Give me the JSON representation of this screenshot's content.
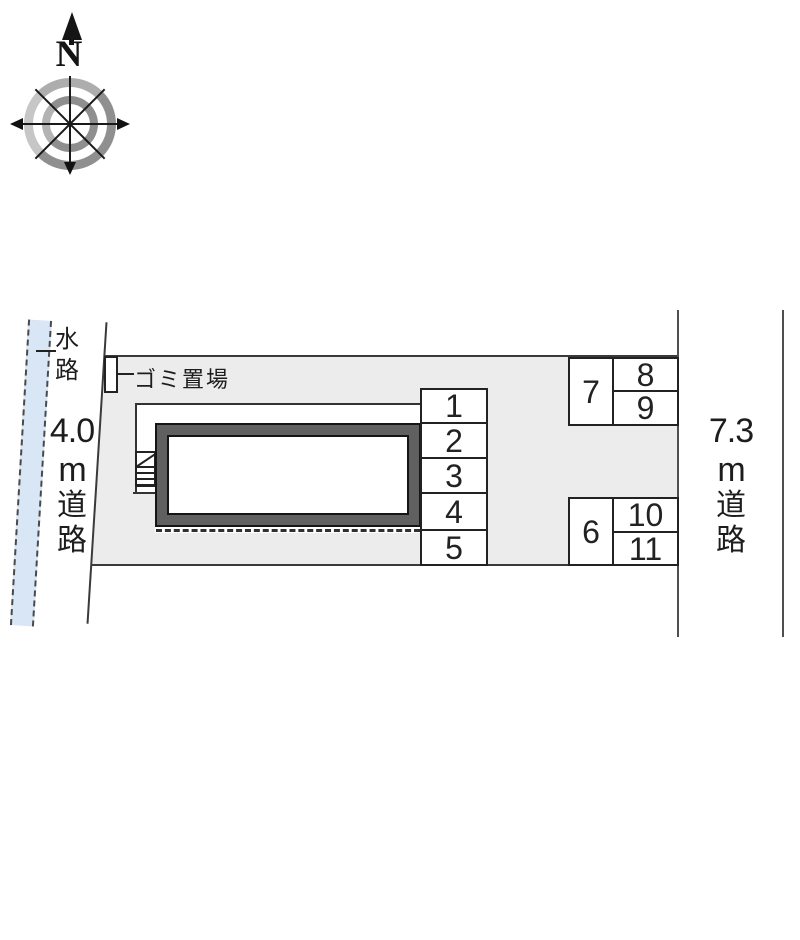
{
  "diagram": {
    "compass": {
      "north_label": "N"
    },
    "waterway_label": {
      "char1": "水",
      "char2": "路"
    },
    "garbage_label": "ゴミ置場",
    "road_left": {
      "size": "4.0",
      "unit": "m",
      "kanji1": "道",
      "kanji2": "路",
      "full_label": "4.0m道路"
    },
    "road_right": {
      "size": "7.3",
      "unit": "m",
      "kanji1": "道",
      "kanji2": "路",
      "full_label": "7.3m道路"
    },
    "parking_spaces": [
      "1",
      "2",
      "3",
      "4",
      "5",
      "6",
      "7",
      "8",
      "9",
      "10",
      "11"
    ]
  },
  "colors": {
    "waterway_fill": "#d9e6f5",
    "site_fill": "#ececec",
    "building_band": "#606060",
    "outline": "#333333"
  }
}
